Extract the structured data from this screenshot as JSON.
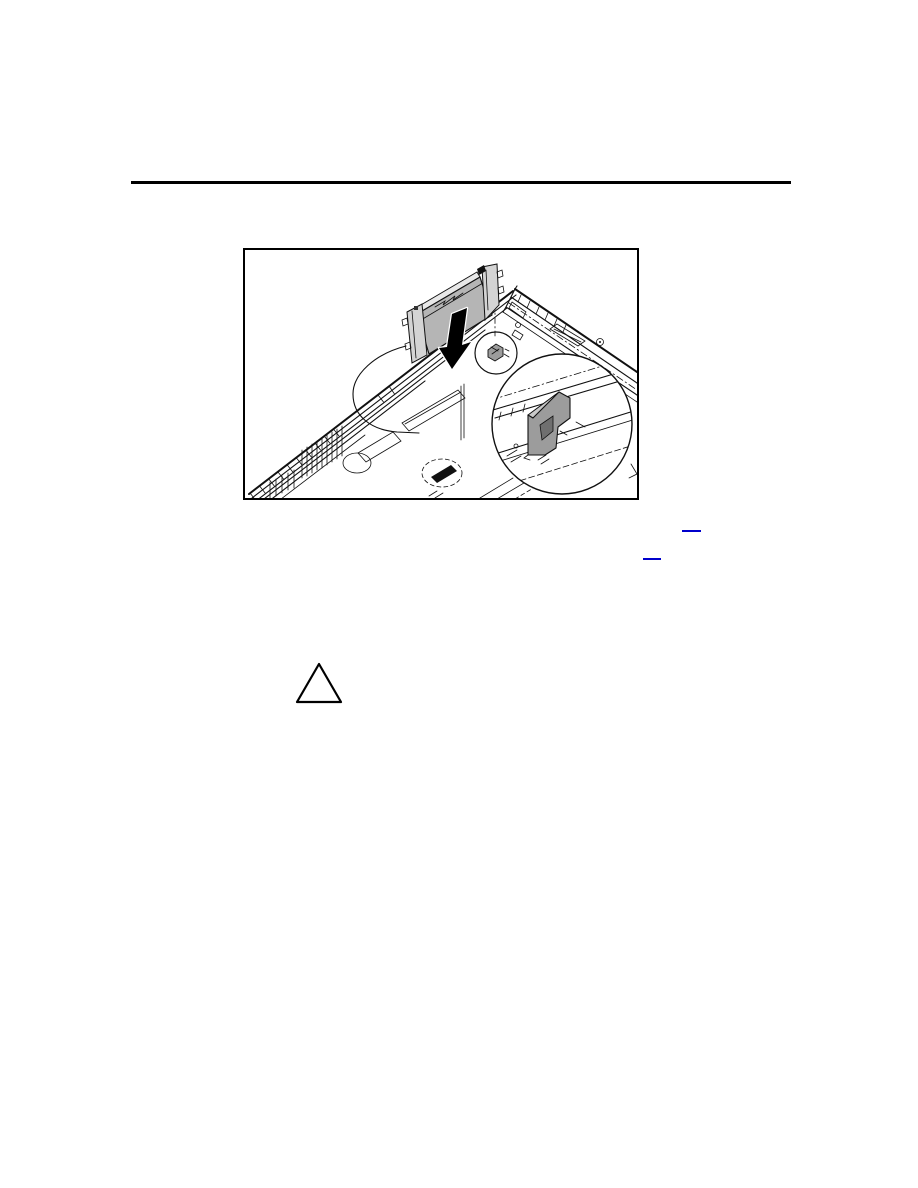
{
  "page": {
    "background_color": "#ffffff"
  },
  "header": {
    "rule_color": "#000000"
  },
  "figure": {
    "frame_border_color": "#000000",
    "illustration": {
      "line_color": "#111111",
      "module_fill": "#b5b5b5",
      "module_top_fill": "#e8e8e8",
      "bracket_fill": "#d4d4d4",
      "arrow_color": "#000000",
      "arrow_outline": "#ffffff",
      "connector_fill": "#9c9c9c",
      "connector_notch_fill": "#6f6f6f",
      "connector_top_fill": "#c9c9c9",
      "clip_fill": "#111111"
    }
  },
  "links": {
    "color": "#0000cc",
    "items": [
      {
        "label": ""
      },
      {
        "label": ""
      }
    ]
  },
  "caution_icon": {
    "stroke_color": "#000000",
    "fill_color": "#ffffff"
  }
}
